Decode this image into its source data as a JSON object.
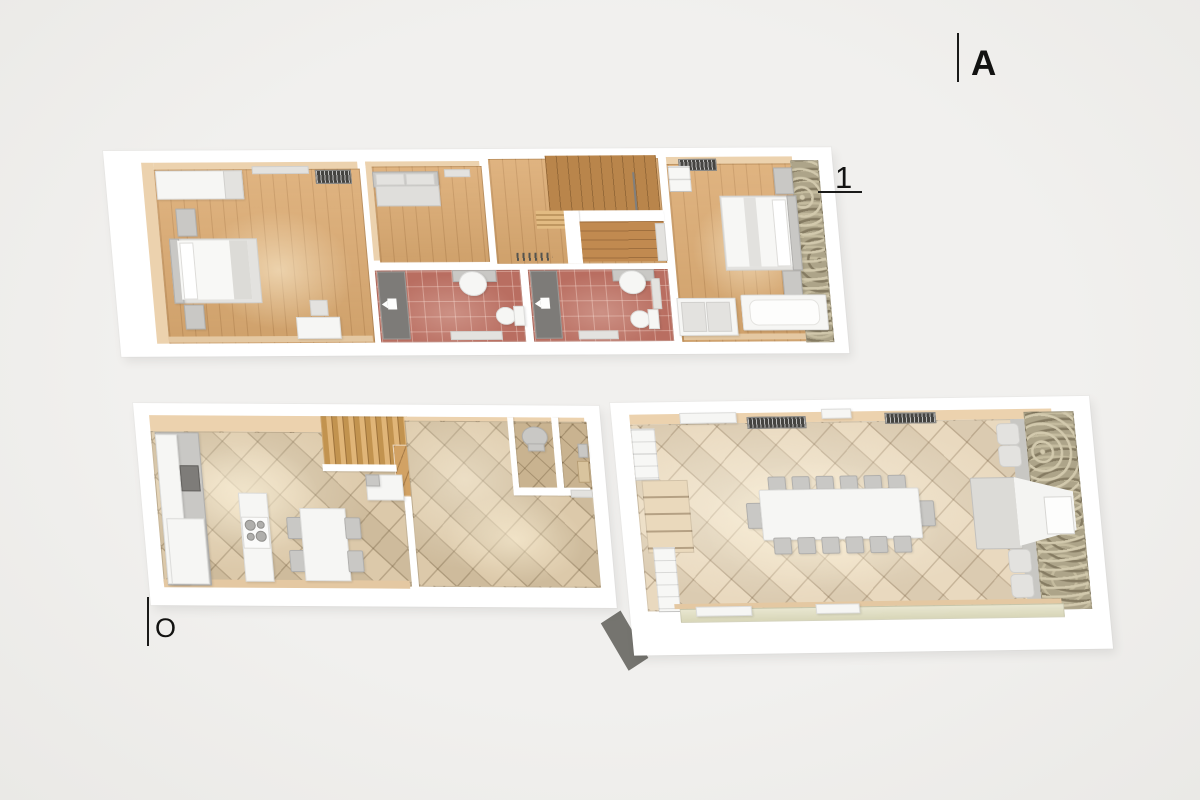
{
  "annotations": {
    "section_marker": "A",
    "upper_floor_label": "1",
    "lower_floor_label": "O"
  },
  "palette": {
    "background": "#efeeec",
    "plan_white": "#ffffff",
    "wood_floor": "#dcab72",
    "wood_dark": "#b9854b",
    "bathroom_tile": "#b96e61",
    "kitchen_tile": "#d9c5a4",
    "dining_tile": "#e7d6ba",
    "stone_wall": "#ada489",
    "wall_face_tan": "#ecd2ae",
    "furniture_white": "#f6f6f4",
    "furniture_gray": "#c9c8c5",
    "door_gray": "#7d7b78",
    "label_color": "#121211"
  }
}
